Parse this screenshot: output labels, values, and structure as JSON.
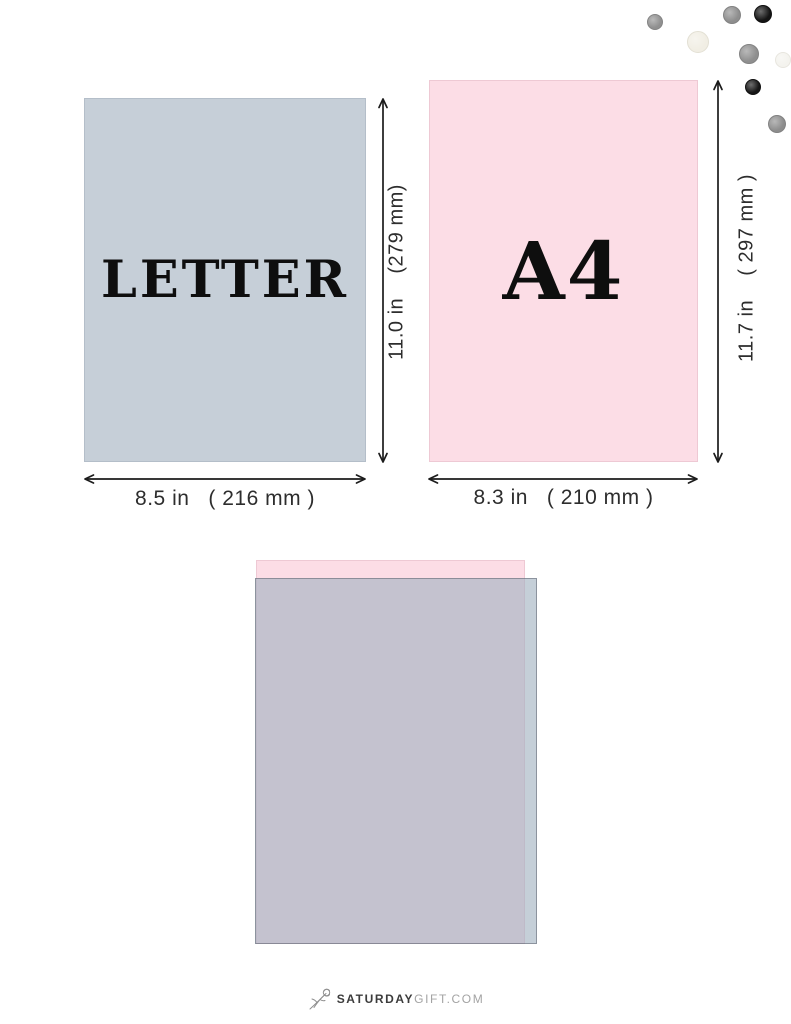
{
  "comparison": {
    "letter": {
      "label": "LETTER",
      "width_label": "8.5 in   ( 216 mm )",
      "height_label": "11.0 in    (279 mm)",
      "fill": "#c6cfd8",
      "border": "#b4bec9"
    },
    "a4": {
      "label": "A4",
      "width_label": "8.3 in   ( 210 mm )",
      "height_label": "11.7 in    ( 297 mm )",
      "fill": "#fcdde6",
      "border": "#eec9d4"
    },
    "arrow_color": "#1c1c1c"
  },
  "overlay": {
    "a4_fill": "#fcdde6",
    "a4_border": "#eec9d4",
    "letter_fill": "rgba(161,177,192,0.62)",
    "letter_border": "rgba(84,88,100,0.5)"
  },
  "decor": {
    "dots": [
      {
        "name": "confetti-dot-gray",
        "x": 655,
        "y": 22,
        "r": 8,
        "color": "#909090",
        "ring": "#848484"
      },
      {
        "name": "confetti-dot-gray",
        "x": 732,
        "y": 15,
        "r": 9,
        "color": "#8e8e8e",
        "ring": "#828282"
      },
      {
        "name": "confetti-dot-black",
        "x": 763,
        "y": 14,
        "r": 9,
        "color": "#141414",
        "ring": "#101010"
      },
      {
        "name": "confetti-dot-cream",
        "x": 698,
        "y": 42,
        "r": 11,
        "color": "#f1eee4",
        "ring": "#e3e0d4"
      },
      {
        "name": "confetti-dot-gray",
        "x": 749,
        "y": 54,
        "r": 10,
        "color": "#8f8f8f",
        "ring": "#838383"
      },
      {
        "name": "confetti-dot-white",
        "x": 783,
        "y": 60,
        "r": 8,
        "color": "#f4f3ee",
        "ring": "#e8e6df"
      },
      {
        "name": "confetti-dot-black",
        "x": 753,
        "y": 87,
        "r": 8,
        "color": "#161616",
        "ring": "#111111"
      },
      {
        "name": "confetti-dot-gray",
        "x": 777,
        "y": 124,
        "r": 9,
        "color": "#8d8d8d",
        "ring": "#818181"
      }
    ]
  },
  "footer": {
    "brand_bold": "SATURDAY",
    "brand_light": "GIFT.COM"
  }
}
